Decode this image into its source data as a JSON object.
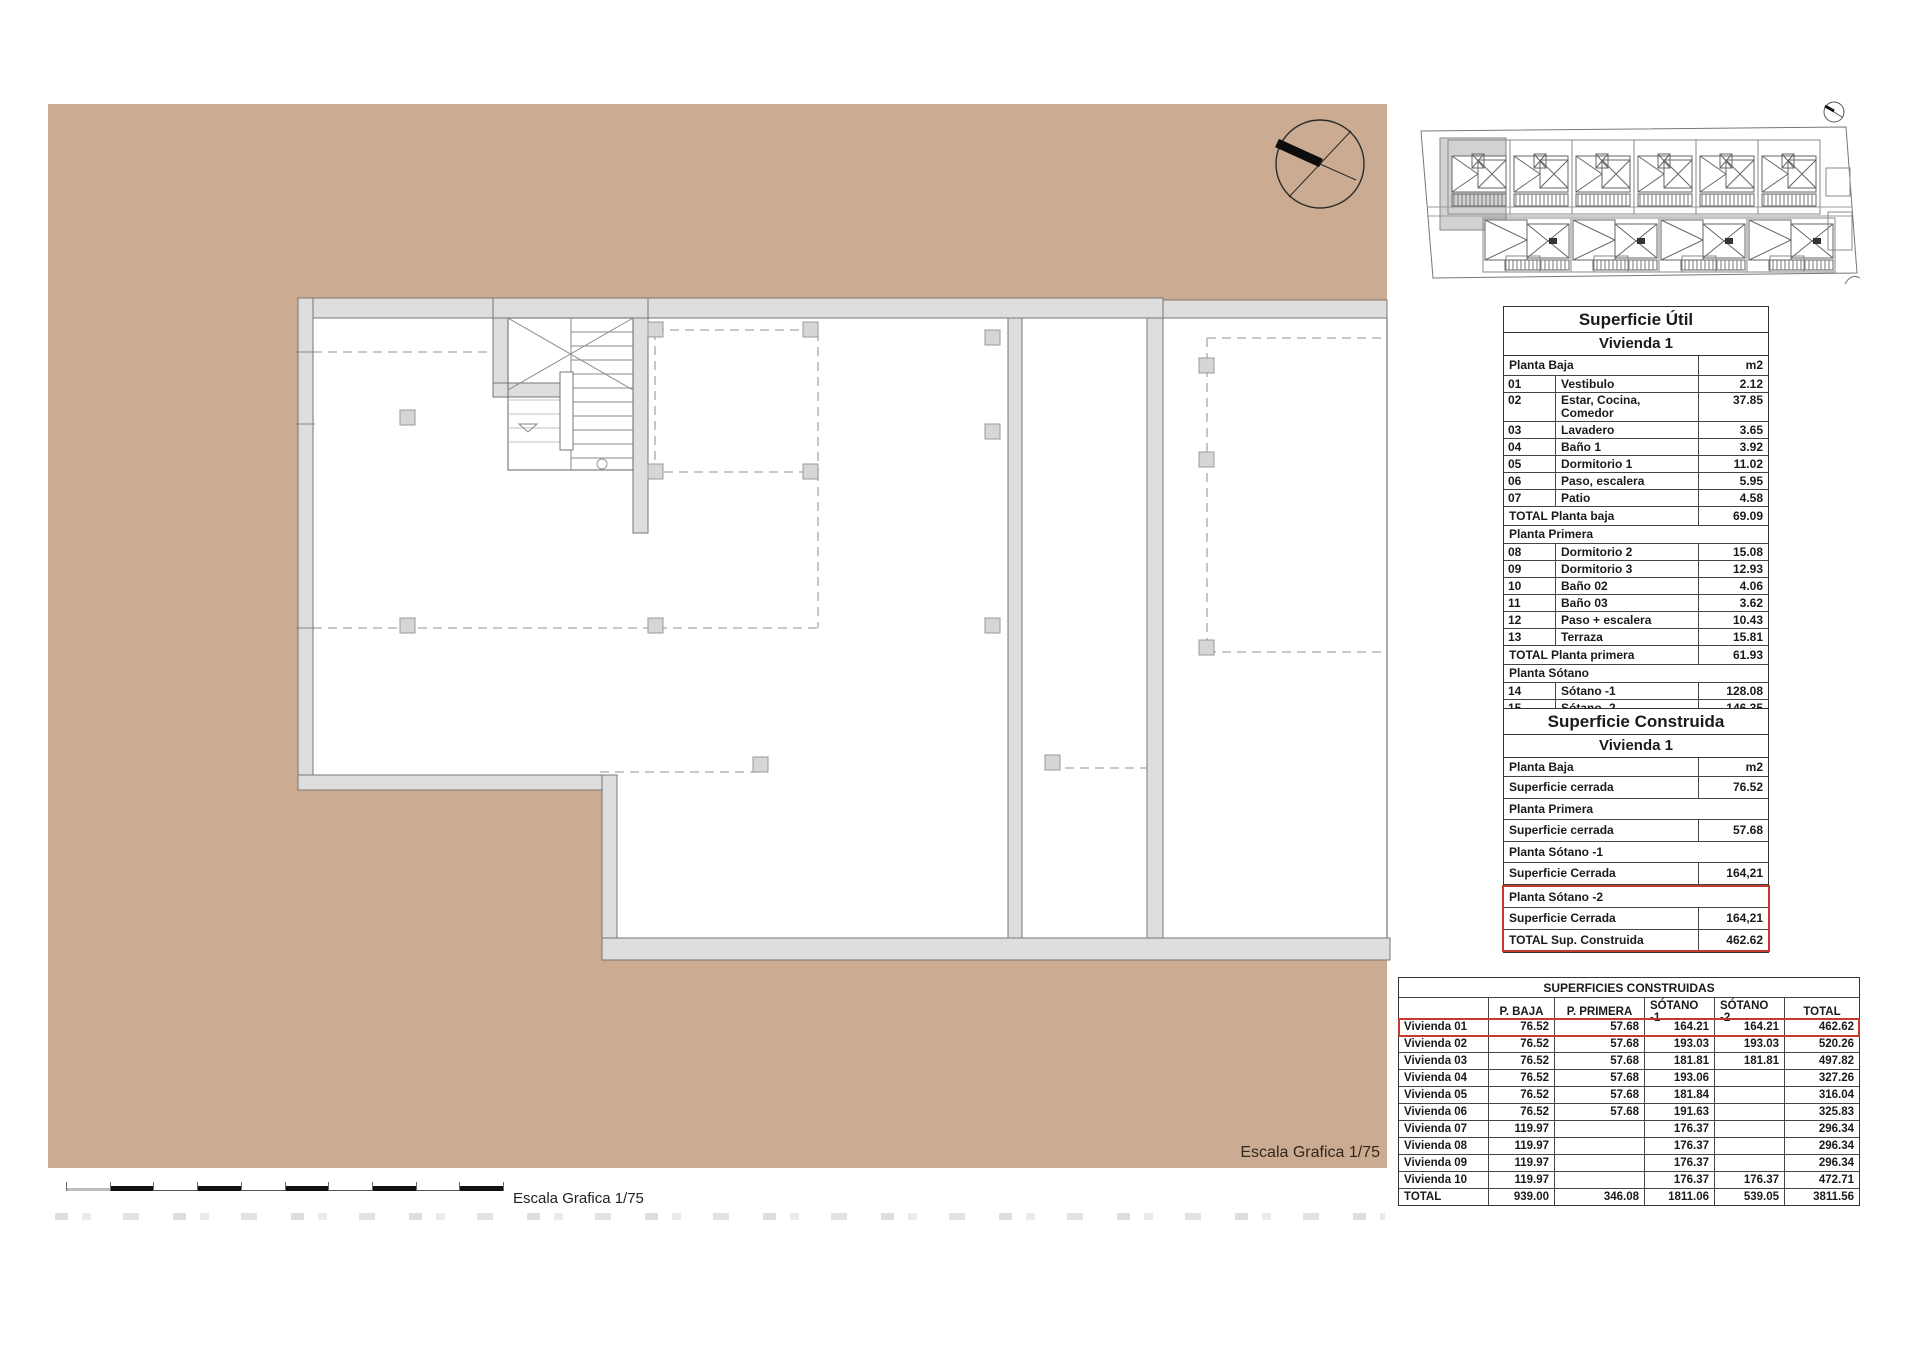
{
  "labels": {
    "escala_plan": "Escala Grafica 1/75",
    "escala_bar": "Escala Grafica 1/75"
  },
  "superficie_util": {
    "title": "Superficie Útil",
    "subtitle": "Vivienda 1",
    "rows": [
      {
        "type": "header",
        "label": "Planta Baja",
        "value": "m2"
      },
      {
        "type": "item",
        "num": "01",
        "label": "Vestibulo",
        "value": "2.12"
      },
      {
        "type": "item_tall",
        "num": "02",
        "label": "Estar, Cocina, Comedor",
        "value": "37.85"
      },
      {
        "type": "item",
        "num": "03",
        "label": "Lavadero",
        "value": "3.65"
      },
      {
        "type": "item",
        "num": "04",
        "label": "Baño 1",
        "value": "3.92"
      },
      {
        "type": "item",
        "num": "05",
        "label": "Dormitorio 1",
        "value": "11.02"
      },
      {
        "type": "item",
        "num": "06",
        "label": "Paso, escalera",
        "value": "5.95"
      },
      {
        "type": "item",
        "num": "07",
        "label": "Patio",
        "value": "4.58"
      },
      {
        "type": "total",
        "label": "TOTAL Planta baja",
        "value": "69.09"
      },
      {
        "type": "section",
        "label": "Planta Primera"
      },
      {
        "type": "item",
        "num": "08",
        "label": "Dormitorio 2",
        "value": "15.08"
      },
      {
        "type": "item",
        "num": "09",
        "label": "Dormitorio 3",
        "value": "12.93"
      },
      {
        "type": "item",
        "num": "10",
        "label": "Baño 02",
        "value": "4.06"
      },
      {
        "type": "item",
        "num": "11",
        "label": "Baño 03",
        "value": "3.62"
      },
      {
        "type": "item",
        "num": "12",
        "label": "Paso + escalera",
        "value": "10.43"
      },
      {
        "type": "item",
        "num": "13",
        "label": "Terraza",
        "value": "15.81"
      },
      {
        "type": "total",
        "label": "TOTAL Planta primera",
        "value": "61.93"
      },
      {
        "type": "section",
        "label": "Planta Sótano"
      },
      {
        "type": "item",
        "num": "14",
        "label": "Sótano -1",
        "value": "128.08"
      },
      {
        "type": "item",
        "num": "15",
        "label": "Sótano -2",
        "value": "146.35"
      },
      {
        "type": "total",
        "label": "TOTAL",
        "value": "405.45"
      }
    ]
  },
  "superficie_construida": {
    "title": "Superficie Construida",
    "subtitle": "Vivienda 1",
    "rows": [
      {
        "type": "header",
        "label": "Planta Baja",
        "value": "m2"
      },
      {
        "type": "value",
        "label": "Superficie cerrada",
        "value": "76.52"
      },
      {
        "type": "section",
        "label": "Planta Primera"
      },
      {
        "type": "value",
        "label": "Superficie cerrada",
        "value": "57.68"
      },
      {
        "type": "section",
        "label": "Planta Sótano -1"
      },
      {
        "type": "value",
        "label": "Superficie Cerrada",
        "value": "164,21"
      },
      {
        "type": "section",
        "label": "Planta Sótano -2",
        "red": true
      },
      {
        "type": "value",
        "label": "Superficie Cerrada",
        "value": "164,21",
        "red": true
      },
      {
        "type": "total",
        "label": "TOTAL Sup. Construida",
        "value": "462.62",
        "red": true
      }
    ]
  },
  "superficies_construidas": {
    "title": "SUPERFICIES CONSTRUIDAS",
    "columns": [
      "P. BAJA",
      "P. PRIMERA",
      "SÓTANO -1",
      "SÓTANO -2",
      "TOTAL"
    ],
    "rows": [
      {
        "name": "Vivienda 01",
        "values": [
          "76.52",
          "57.68",
          "164.21",
          "164.21",
          "462.62"
        ],
        "highlight": true
      },
      {
        "name": "Vivienda 02",
        "values": [
          "76.52",
          "57.68",
          "193.03",
          "193.03",
          "520.26"
        ]
      },
      {
        "name": "Vivienda 03",
        "values": [
          "76.52",
          "57.68",
          "181.81",
          "181.81",
          "497.82"
        ]
      },
      {
        "name": "Vivienda 04",
        "values": [
          "76.52",
          "57.68",
          "193.06",
          "",
          "327.26"
        ]
      },
      {
        "name": "Vivienda 05",
        "values": [
          "76.52",
          "57.68",
          "181.84",
          "",
          "316.04"
        ]
      },
      {
        "name": "Vivienda 06",
        "values": [
          "76.52",
          "57.68",
          "191.63",
          "",
          "325.83"
        ]
      },
      {
        "name": "Vivienda 07",
        "values": [
          "119.97",
          "",
          "176.37",
          "",
          "296.34"
        ]
      },
      {
        "name": "Vivienda 08",
        "values": [
          "119.97",
          "",
          "176.37",
          "",
          "296.34"
        ]
      },
      {
        "name": "Vivienda 09",
        "values": [
          "119.97",
          "",
          "176.37",
          "",
          "296.34"
        ]
      },
      {
        "name": "Vivienda 10",
        "values": [
          "119.97",
          "",
          "176.37",
          "176.37",
          "472.71"
        ]
      },
      {
        "name": "TOTAL",
        "values": [
          "939.00",
          "346.08",
          "1811.06",
          "539.05",
          "3811.56"
        ]
      }
    ]
  }
}
